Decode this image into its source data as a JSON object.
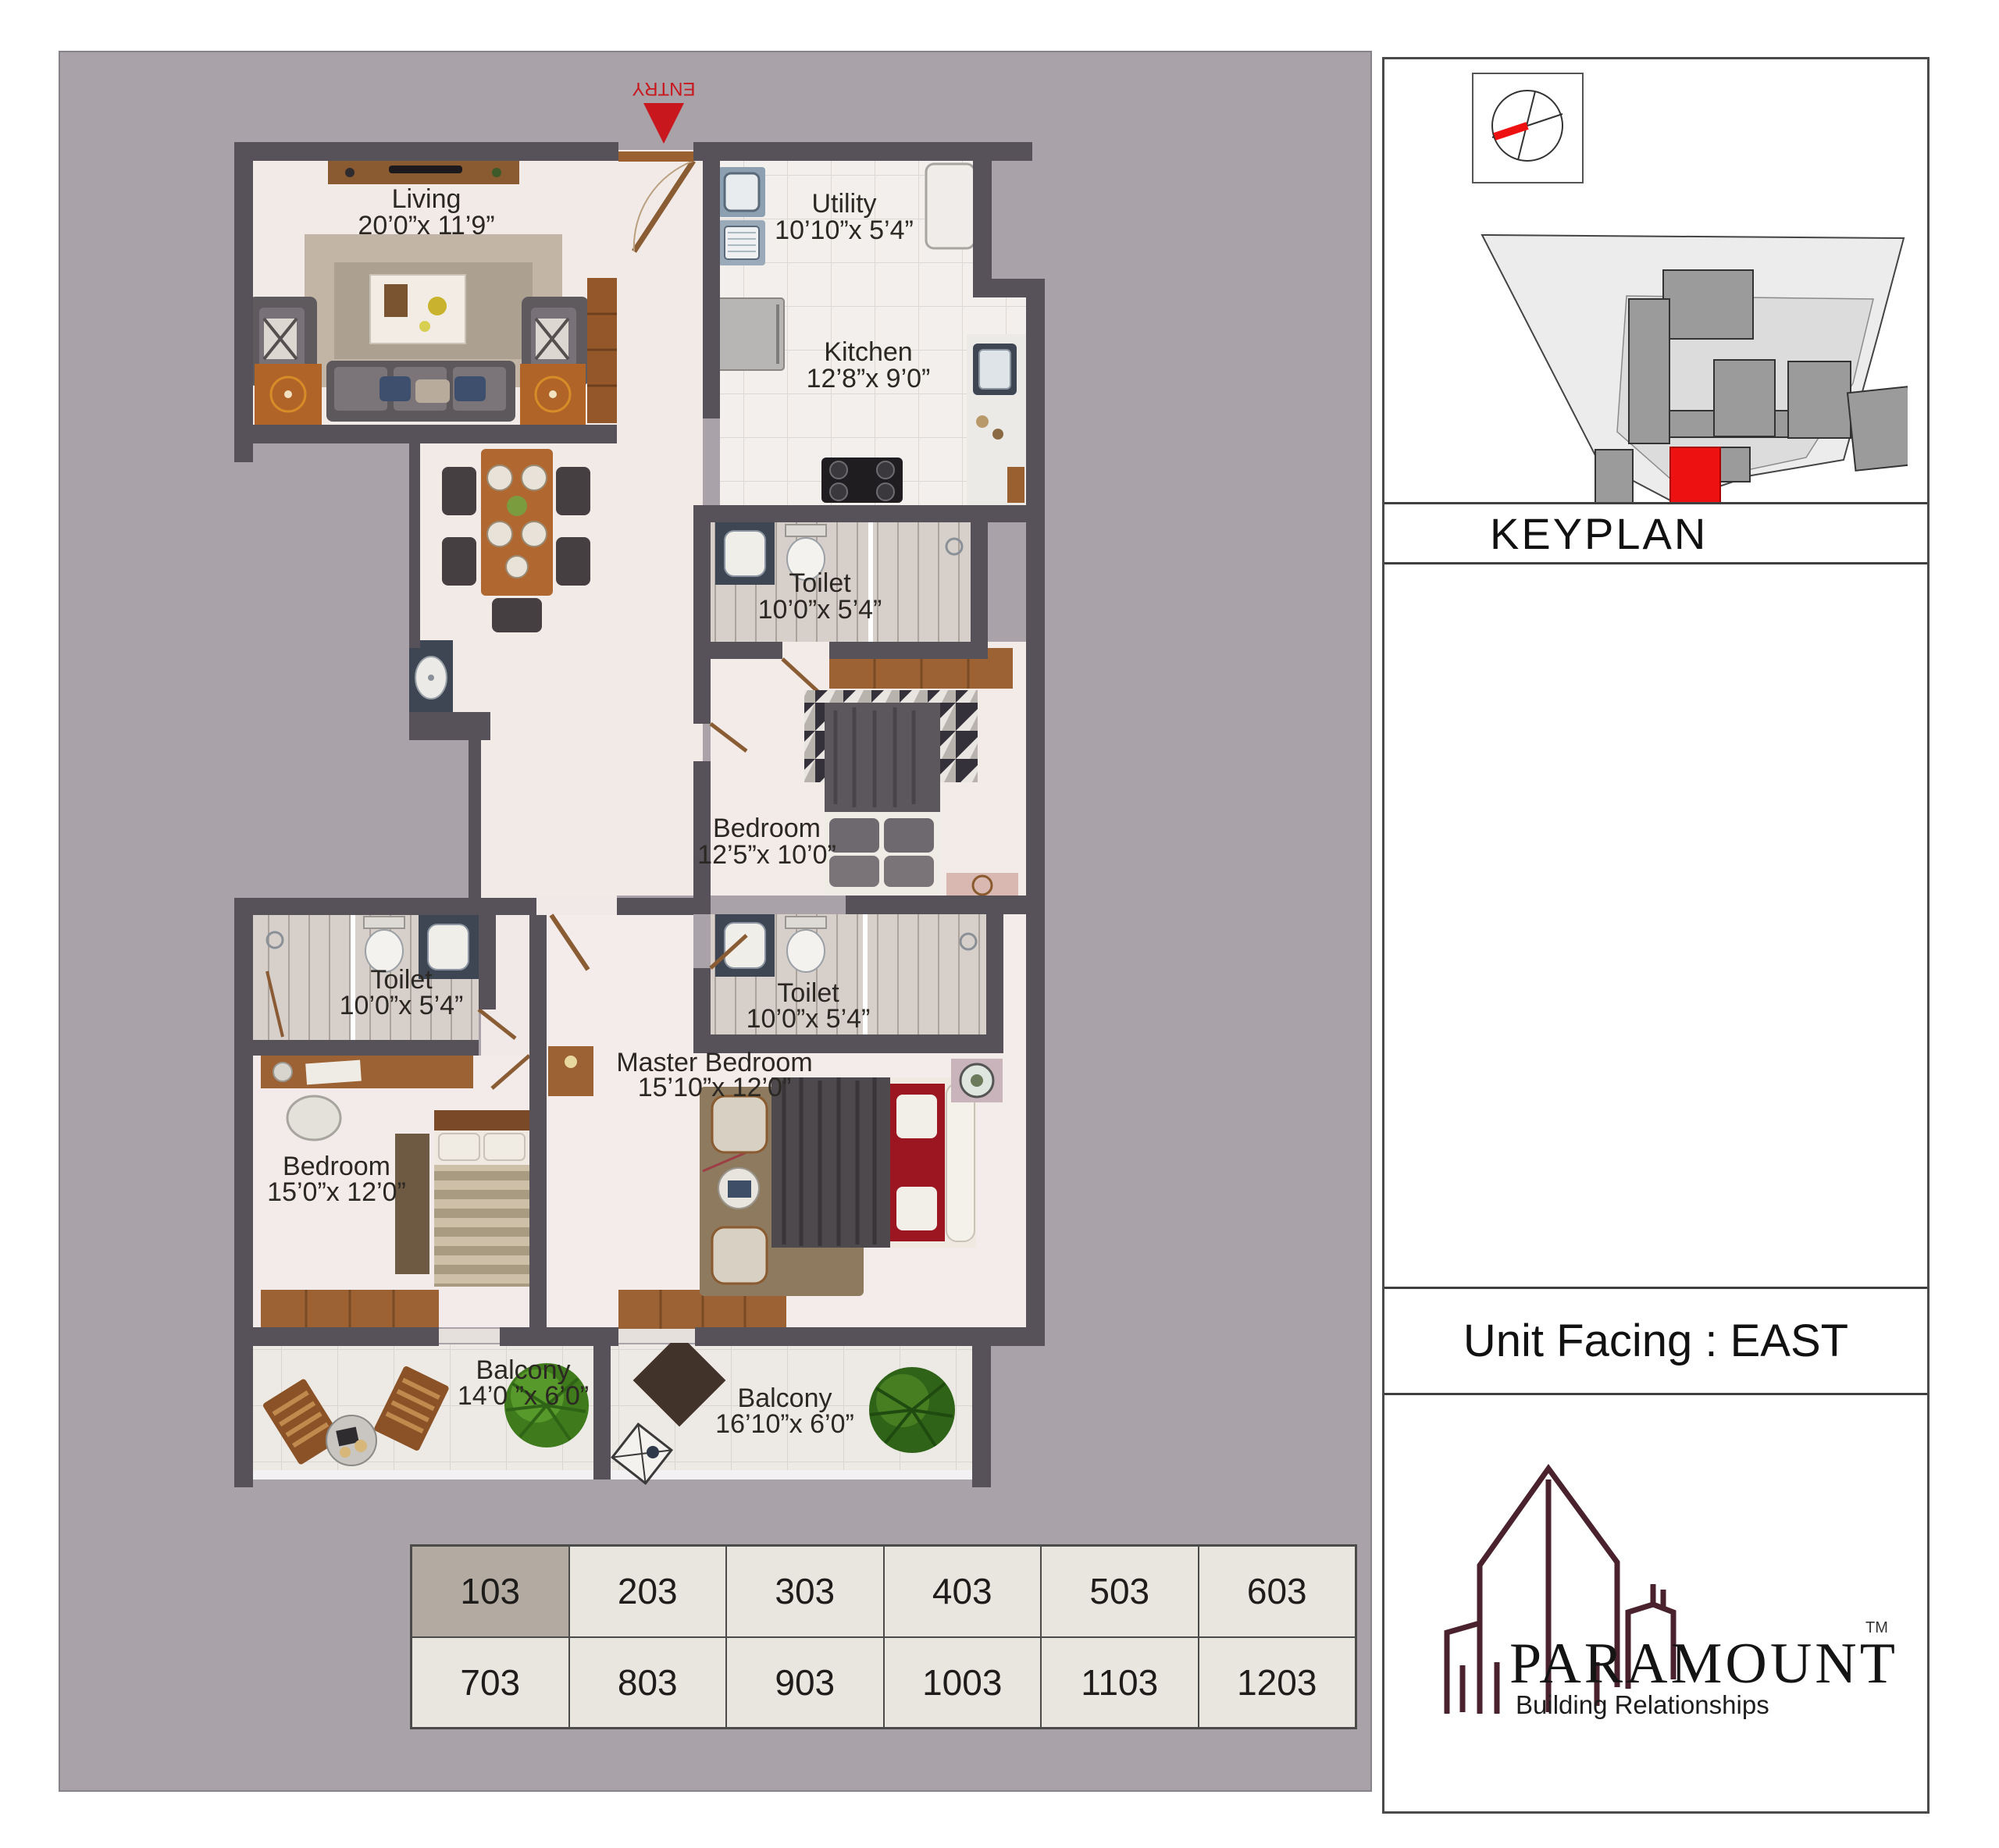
{
  "floor_plan": {
    "entry_label": "ENTRY",
    "rooms": [
      {
        "name": "Living",
        "dims": "20’0”x 11’9”"
      },
      {
        "name": "Utility",
        "dims": "10’10”x 5’4”"
      },
      {
        "name": "Kitchen",
        "dims": "12’8”x 9’0”"
      },
      {
        "name": "Toilet",
        "dims": "10’0”x 5’4”"
      },
      {
        "name": "Bedroom",
        "dims": "12’5”x 10’0”"
      },
      {
        "name": "Toilet",
        "dims": "10’0”x 5’4”"
      },
      {
        "name": "Toilet",
        "dims": "10’0”x 5’4”"
      },
      {
        "name": "Bedroom",
        "dims": "15’0”x 12’0”"
      },
      {
        "name": "Master Bedroom",
        "dims": "15’10”x 12’0”"
      },
      {
        "name": "Balcony",
        "dims": "14’0 ”x 6’0”"
      },
      {
        "name": "Balcony",
        "dims": "16’10”x 6’0”"
      }
    ]
  },
  "keyplan": {
    "label": "KEYPLAN"
  },
  "unit_facing": {
    "label": "Unit Facing : EAST"
  },
  "brand": {
    "name": "PARAMOUNT",
    "tm": "TM",
    "tagline": "Building Relationships"
  },
  "units": {
    "rows": [
      [
        "103",
        "203",
        "303",
        "403",
        "503",
        "603"
      ],
      [
        "703",
        "803",
        "903",
        "1003",
        "1103",
        "1203"
      ]
    ],
    "selected": "103"
  },
  "colors": {
    "wall": "#57515a",
    "panel_bg": "#a9a3a9",
    "floor_cream": "#f1eae6",
    "accent_red": "#c8171d",
    "keyplan_unit_red": "#ee1111",
    "logo_maroon": "#4a222e",
    "unit_selected_bg": "#b3aba1",
    "unit_cell_bg": "#e9e5df"
  }
}
